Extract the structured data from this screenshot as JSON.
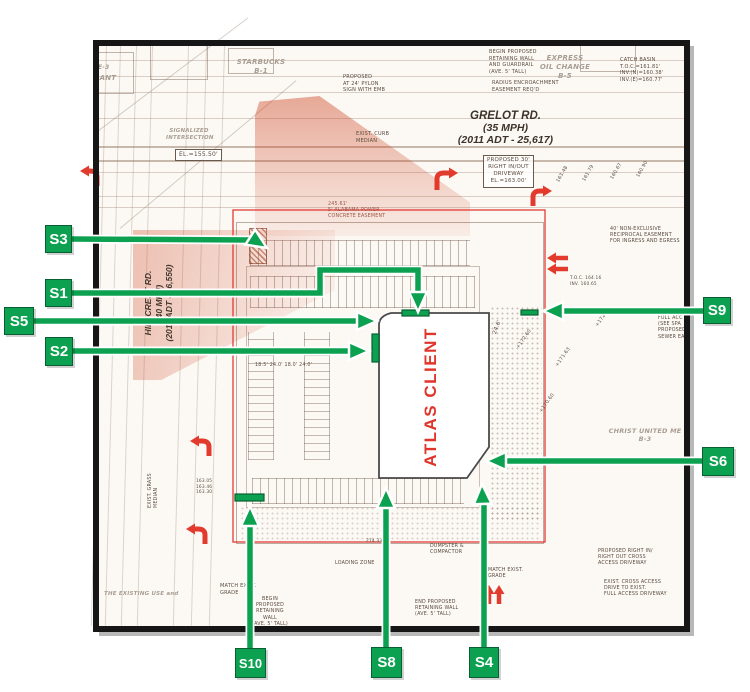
{
  "colors": {
    "callout_green": "#0ca150",
    "callout_border": "#0a5f32",
    "accent_red": "#e0352b",
    "boundary_red": "#e23b35",
    "tint_orange": "#dd5a2e",
    "plan_line_gray": "#8a7a6e"
  },
  "building": {
    "label": "ATLAS CLIENT"
  },
  "roads": {
    "grelot": {
      "name": "GRELOT RD.",
      "speed": "(35 MPH)",
      "adt": "(2011 ADT - 25,617)"
    },
    "hillcrest": {
      "name": "HILLCREST RD.",
      "speed": "(40 MPH)",
      "adt": "(2011 ADT - 26,550)"
    }
  },
  "callouts": [
    {
      "id": "s3",
      "label": "S3"
    },
    {
      "id": "s1",
      "label": "S1"
    },
    {
      "id": "s5",
      "label": "S5"
    },
    {
      "id": "s2",
      "label": "S2"
    },
    {
      "id": "s9",
      "label": "S9"
    },
    {
      "id": "s6",
      "label": "S6"
    },
    {
      "id": "s10",
      "label": "S10"
    },
    {
      "id": "s8",
      "label": "S8"
    },
    {
      "id": "s4",
      "label": "S4"
    }
  ],
  "annotations": [
    {
      "id": "label-e3",
      "text": "E-3"
    },
    {
      "id": "label-rant",
      "text": "RANT"
    },
    {
      "id": "starbucks",
      "text": "STARBUCKS\nB-1"
    },
    {
      "id": "express-oil",
      "text": "EXPRESS\nOIL CHANGE\nB-5"
    },
    {
      "id": "pylon-sign",
      "text": "PROPOSED\nAT 24' PYLON\nSIGN WITH EMB"
    },
    {
      "id": "curb-median",
      "text": "EXIST. CURB\nMEDIAN"
    },
    {
      "id": "begin-wall-top",
      "text": "BEGIN PROPOSED\nRETAINING WALL\nAND GUARDRAIL\n(AVE. 5' TALL)"
    },
    {
      "id": "radius-easement",
      "text": "RADIUS ENCROACHMENT\nEASEMENT REQ'D"
    },
    {
      "id": "catch-basin",
      "text": "CATCH BASIN\nT.O.C.=161.81'\nINV.(N)=160.38'\nINV.(E)=160.77'"
    },
    {
      "id": "driveway-box",
      "text": "PROPOSED 30'\nRIGHT IN/OUT\nDRIVEWAY\nEL.=163.00'"
    },
    {
      "id": "el-box",
      "text": "EL.=155.50'"
    },
    {
      "id": "signalized",
      "text": "SIGNALIZED\nINTERSECTION"
    },
    {
      "id": "alabama-power",
      "text": "245.61'\n5' ALABAMA POWER\nCONCRETE EASEMENT"
    },
    {
      "id": "reciprocal-easement",
      "text": "40' NON-EXCLUSIVE\nRECIPROCAL EASEMENT\nFOR INGRESS AND EGRESS"
    },
    {
      "id": "full-access",
      "text": "FULL ACC\n(SEE SPA\nPROPOSED\nSEWER EA"
    },
    {
      "id": "christ-united",
      "text": "CHRIST UNITED ME\nB-3"
    },
    {
      "id": "dim-246",
      "text": "24.6'"
    },
    {
      "id": "spot-17260",
      "text": "+172.60"
    },
    {
      "id": "spot-17237",
      "text": "+172.37"
    },
    {
      "id": "spot-17163",
      "text": "+171.63"
    },
    {
      "id": "spot-17060",
      "text": "+170.60"
    },
    {
      "id": "sta-16348",
      "text": "163.48"
    },
    {
      "id": "sta-16179",
      "text": "161.79"
    },
    {
      "id": "sta-16067",
      "text": "160.67"
    },
    {
      "id": "sta-16090",
      "text": "160.90"
    },
    {
      "id": "parking-dims",
      "text": "18.5'   24.0'   18.0'   24.0'"
    },
    {
      "id": "match-grade-1",
      "text": "MATCH EXIST.\nGRADE"
    },
    {
      "id": "begin-wall-bottom",
      "text": "BEGIN\nPROPOSED\nRETAINING\nWALL\n(AVE. 5' TALL)"
    },
    {
      "id": "end-wall",
      "text": "END PROPOSED\nRETAINING WALL\n(AVE. 5' TALL)"
    },
    {
      "id": "dumpster",
      "text": "DUMPSTER &\nCOMPACTOR"
    },
    {
      "id": "match-grade-2",
      "text": "MATCH EXIST.\nGRADE"
    },
    {
      "id": "right-in-out",
      "text": "PROPOSED RIGHT IN/\nRIGHT OUT CROSS\nACCESS DRIVEWAY"
    },
    {
      "id": "cross-access",
      "text": "EXIST. CROSS ACCESS\nDRIVE TO EXIST.\nFULL ACCESS DRIVEWAY"
    },
    {
      "id": "loading-zone",
      "text": "LOADING ZONE"
    },
    {
      "id": "grass-median",
      "text": "EXIST. GRASS\nMEDIAN"
    },
    {
      "id": "existing-use",
      "text": "THE EXISTING USE and"
    },
    {
      "id": "elev-stack",
      "text": "163.05\n163.46\n163.30"
    },
    {
      "id": "toc-1",
      "text": "T.O.C. 164.16\nINV. 160.65"
    },
    {
      "id": "dim-274",
      "text": "274.33'"
    }
  ]
}
